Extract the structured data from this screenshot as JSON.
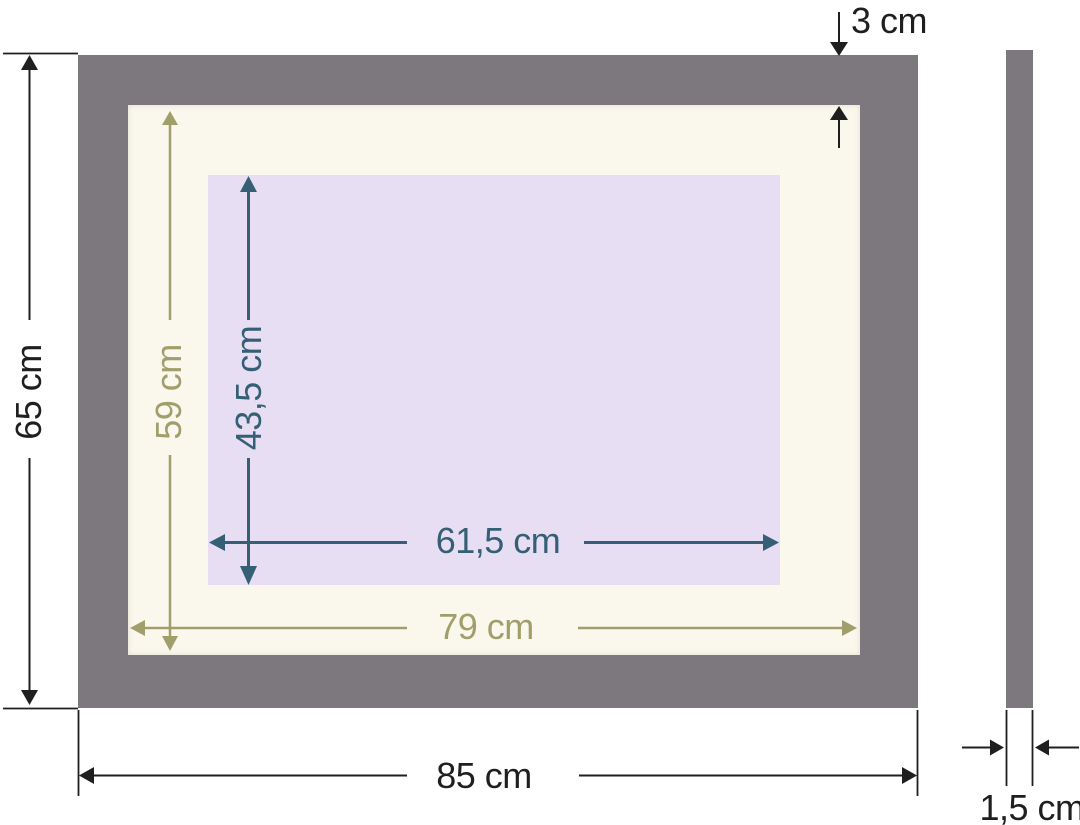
{
  "title": "Picture frame dimension diagram",
  "colors": {
    "background": "#ffffff",
    "frame": "#7d787d",
    "mat": "#faf7ec",
    "opening": "#e8def4",
    "dim_black": "#1f1f1f",
    "dim_olive": "#a09f6b",
    "dim_teal": "#355f74"
  },
  "front_view": {
    "outer_height_label": "65 cm",
    "outer_width_label": "85 cm",
    "frame_face_width_label": "3 cm",
    "mat_height_label": "59 cm",
    "mat_width_label": "79 cm",
    "opening_height_label": "43,5 cm",
    "opening_width_label": "61,5 cm"
  },
  "side_view": {
    "depth_label": "1,5 cm"
  }
}
